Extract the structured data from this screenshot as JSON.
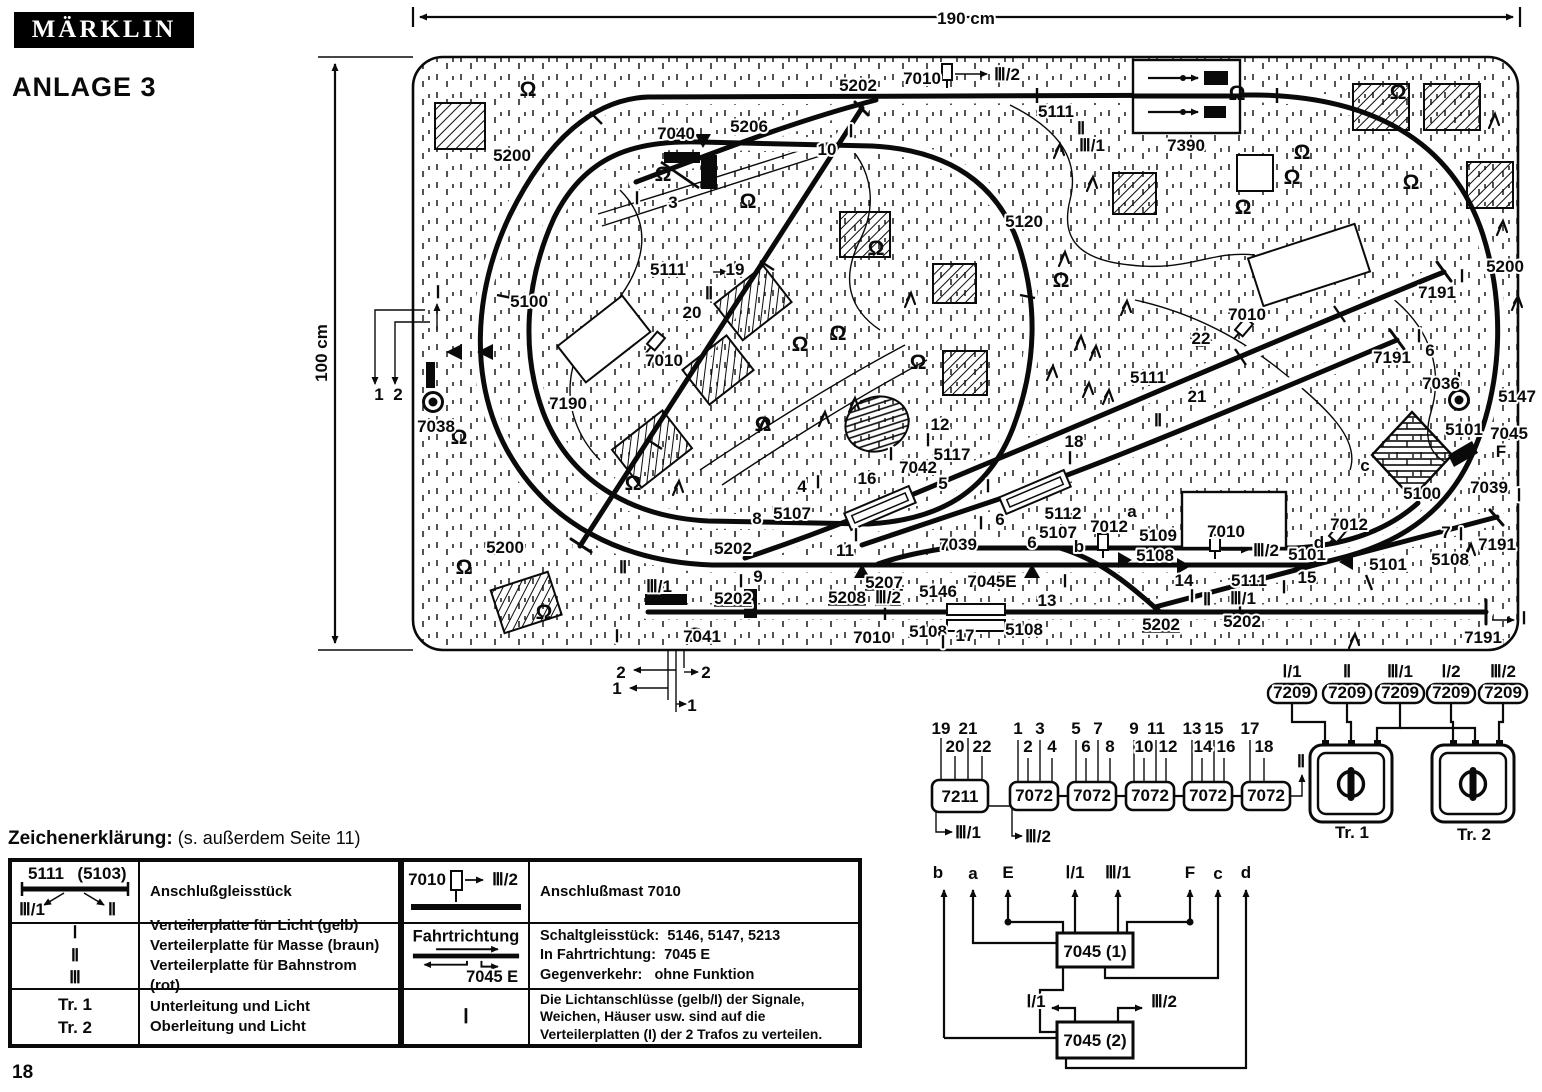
{
  "header": {
    "logo": "MÄRKLIN",
    "title": "ANLAGE 3"
  },
  "page": {
    "number": "18"
  },
  "plan": {
    "dim_w": "190 cm",
    "dim_h": "100 cm",
    "labels": [
      {
        "t": "5202",
        "x": 858,
        "y": 91
      },
      {
        "t": "7010",
        "x": 922,
        "y": 84
      },
      {
        "t": "Ⅲ/2",
        "x": 1007,
        "y": 80
      },
      {
        "t": "5111",
        "x": 1056,
        "y": 117,
        "s": 15
      },
      {
        "t": "Ⅱ",
        "x": 1081,
        "y": 134,
        "s": 15
      },
      {
        "t": "Ⅲ/1",
        "x": 1092,
        "y": 151,
        "s": 15
      },
      {
        "t": "7390",
        "x": 1186,
        "y": 151
      },
      {
        "t": "7040",
        "x": 676,
        "y": 139
      },
      {
        "t": "5206",
        "x": 749,
        "y": 132
      },
      {
        "t": "10",
        "x": 827,
        "y": 155,
        "s": 15
      },
      {
        "t": "Ⅰ",
        "x": 851,
        "y": 137,
        "s": 15
      },
      {
        "t": "Ⅰ",
        "x": 637,
        "y": 204,
        "s": 15
      },
      {
        "t": "3",
        "x": 673,
        "y": 208,
        "s": 15
      },
      {
        "t": "5200",
        "x": 512,
        "y": 161
      },
      {
        "t": "5120",
        "x": 1024,
        "y": 227
      },
      {
        "t": "5200",
        "x": 1505,
        "y": 272
      },
      {
        "t": "5111",
        "x": 668,
        "y": 275
      },
      {
        "t": "19",
        "x": 735,
        "y": 275,
        "s": 15
      },
      {
        "t": "Ⅱ",
        "x": 709,
        "y": 299,
        "s": 15
      },
      {
        "t": "20",
        "x": 692,
        "y": 318,
        "s": 15
      },
      {
        "t": "7010",
        "x": 664,
        "y": 366
      },
      {
        "t": "5100",
        "x": 529,
        "y": 307
      },
      {
        "t": "7190",
        "x": 568,
        "y": 409
      },
      {
        "t": "Ⅰ",
        "x": 438,
        "y": 298,
        "s": 15
      },
      {
        "t": "1",
        "x": 379,
        "y": 400,
        "s": 15
      },
      {
        "t": "2",
        "x": 398,
        "y": 400,
        "s": 15
      },
      {
        "t": "7038",
        "x": 436,
        "y": 432
      },
      {
        "t": "Ⅰ",
        "x": 1462,
        "y": 282,
        "s": 15
      },
      {
        "t": "7191",
        "x": 1437,
        "y": 298
      },
      {
        "t": "7010",
        "x": 1247,
        "y": 320
      },
      {
        "t": "22",
        "x": 1201,
        "y": 344,
        "s": 15
      },
      {
        "t": "5111",
        "x": 1148,
        "y": 383,
        "s": 15
      },
      {
        "t": "21",
        "x": 1197,
        "y": 402,
        "s": 15
      },
      {
        "t": "Ⅱ",
        "x": 1158,
        "y": 426,
        "s": 15
      },
      {
        "t": "7191",
        "x": 1392,
        "y": 363
      },
      {
        "t": "Ⅰ",
        "x": 1419,
        "y": 342,
        "s": 15
      },
      {
        "t": "6",
        "x": 1430,
        "y": 356,
        "s": 15
      },
      {
        "t": "7036",
        "x": 1441,
        "y": 389
      },
      {
        "t": "5147",
        "x": 1517,
        "y": 402
      },
      {
        "t": "5101",
        "x": 1464,
        "y": 435
      },
      {
        "t": "7045",
        "x": 1509,
        "y": 439
      },
      {
        "t": "F",
        "x": 1501,
        "y": 457
      },
      {
        "t": "c",
        "x": 1365,
        "y": 471,
        "s": 15
      },
      {
        "t": "5100",
        "x": 1422,
        "y": 499
      },
      {
        "t": "7039",
        "x": 1489,
        "y": 493
      },
      {
        "t": "Ⅰ",
        "x": 1519,
        "y": 501,
        "s": 15
      },
      {
        "t": "12",
        "x": 940,
        "y": 430,
        "s": 15
      },
      {
        "t": "Ⅰ",
        "x": 928,
        "y": 446,
        "s": 15
      },
      {
        "t": "5117",
        "x": 952,
        "y": 460
      },
      {
        "t": "7042",
        "x": 918,
        "y": 473
      },
      {
        "t": "Ⅰ",
        "x": 891,
        "y": 460,
        "s": 15
      },
      {
        "t": "16",
        "x": 867,
        "y": 484,
        "s": 15
      },
      {
        "t": "Ⅰ",
        "x": 818,
        "y": 488,
        "s": 15
      },
      {
        "t": "4",
        "x": 802,
        "y": 492,
        "s": 15
      },
      {
        "t": "5107",
        "x": 792,
        "y": 519
      },
      {
        "t": "8",
        "x": 757,
        "y": 524,
        "s": 15
      },
      {
        "t": "5",
        "x": 943,
        "y": 489,
        "s": 15
      },
      {
        "t": "Ⅰ",
        "x": 988,
        "y": 492,
        "s": 15
      },
      {
        "t": "18",
        "x": 1074,
        "y": 447,
        "s": 15
      },
      {
        "t": "Ⅰ",
        "x": 1070,
        "y": 464,
        "s": 15
      },
      {
        "t": "5112",
        "x": 1063,
        "y": 519
      },
      {
        "t": "Ⅰ",
        "x": 981,
        "y": 529,
        "s": 15
      },
      {
        "t": "6",
        "x": 1000,
        "y": 525,
        "s": 15
      },
      {
        "t": "6",
        "x": 1032,
        "y": 548,
        "s": 15
      },
      {
        "t": "7039",
        "x": 958,
        "y": 550
      },
      {
        "t": "5107",
        "x": 1058,
        "y": 538
      },
      {
        "t": "7012",
        "x": 1109,
        "y": 532
      },
      {
        "t": "a",
        "x": 1132,
        "y": 517,
        "s": 15
      },
      {
        "t": "b",
        "x": 1079,
        "y": 552,
        "s": 15
      },
      {
        "t": "5109",
        "x": 1158,
        "y": 541
      },
      {
        "t": "5108",
        "x": 1155,
        "y": 561
      },
      {
        "t": "Ⅰ",
        "x": 856,
        "y": 541,
        "s": 15
      },
      {
        "t": "11",
        "x": 845,
        "y": 556,
        "s": 15
      },
      {
        "t": "5200",
        "x": 505,
        "y": 553
      },
      {
        "t": "Ⅱ",
        "x": 623,
        "y": 573,
        "s": 15
      },
      {
        "t": "Ⅲ/1",
        "x": 659,
        "y": 592,
        "s": 15
      },
      {
        "t": "5202",
        "x": 733,
        "y": 554
      },
      {
        "t": "Ⅰ",
        "x": 741,
        "y": 587,
        "s": 15
      },
      {
        "t": "9",
        "x": 758,
        "y": 582,
        "s": 15
      },
      {
        "t": "5202",
        "x": 733,
        "y": 604,
        "u": 1
      },
      {
        "t": "5207",
        "x": 884,
        "y": 588,
        "u": 1
      },
      {
        "t": "5208",
        "x": 847,
        "y": 603,
        "u": 1
      },
      {
        "t": "Ⅲ/2",
        "x": 888,
        "y": 603,
        "u": 1
      },
      {
        "t": "5146",
        "x": 938,
        "y": 597
      },
      {
        "t": "7045E",
        "x": 992,
        "y": 587
      },
      {
        "t": "Ⅰ",
        "x": 1065,
        "y": 587,
        "s": 15
      },
      {
        "t": "13",
        "x": 1047,
        "y": 606,
        "s": 15
      },
      {
        "t": "7010",
        "x": 872,
        "y": 643
      },
      {
        "t": "5108",
        "x": 928,
        "y": 637
      },
      {
        "t": "Ⅰ",
        "x": 943,
        "y": 648,
        "s": 15
      },
      {
        "t": "17",
        "x": 965,
        "y": 641,
        "s": 15
      },
      {
        "t": "5108",
        "x": 1024,
        "y": 635
      },
      {
        "t": "5202",
        "x": 1161,
        "y": 630,
        "u": 1
      },
      {
        "t": "5202",
        "x": 1242,
        "y": 627
      },
      {
        "t": "7041",
        "x": 702,
        "y": 642
      },
      {
        "t": "Ⅰ",
        "x": 617,
        "y": 642,
        "s": 15
      },
      {
        "t": "2",
        "x": 621,
        "y": 678,
        "s": 15
      },
      {
        "t": "2",
        "x": 706,
        "y": 678,
        "s": 15
      },
      {
        "t": "1",
        "x": 617,
        "y": 694,
        "s": 15
      },
      {
        "t": "1",
        "x": 692,
        "y": 711,
        "s": 15
      },
      {
        "t": "14",
        "x": 1184,
        "y": 586,
        "s": 15
      },
      {
        "t": "Ⅰ",
        "x": 1192,
        "y": 602,
        "s": 15
      },
      {
        "t": "Ⅱ",
        "x": 1207,
        "y": 605,
        "s": 15
      },
      {
        "t": "Ⅲ/1",
        "x": 1243,
        "y": 604,
        "s": 15
      },
      {
        "t": "5111",
        "x": 1249,
        "y": 586,
        "s": 15
      },
      {
        "t": "Ⅰ",
        "x": 1284,
        "y": 593,
        "s": 15
      },
      {
        "t": "15",
        "x": 1307,
        "y": 583,
        "s": 15
      },
      {
        "t": "7010",
        "x": 1226,
        "y": 537
      },
      {
        "t": "Ⅲ/2",
        "x": 1266,
        "y": 556,
        "s": 15
      },
      {
        "t": "5101",
        "x": 1307,
        "y": 560
      },
      {
        "t": "d",
        "x": 1319,
        "y": 548,
        "s": 15
      },
      {
        "t": "7012",
        "x": 1349,
        "y": 530
      },
      {
        "t": "5101",
        "x": 1388,
        "y": 570
      },
      {
        "t": "7",
        "x": 1446,
        "y": 538,
        "s": 15
      },
      {
        "t": "Ⅰ",
        "x": 1461,
        "y": 540,
        "s": 15
      },
      {
        "t": "5108",
        "x": 1450,
        "y": 565
      },
      {
        "t": "7191",
        "x": 1497,
        "y": 550
      },
      {
        "t": "7191",
        "x": 1483,
        "y": 643
      },
      {
        "t": "Ⅰ",
        "x": 1524,
        "y": 624,
        "s": 15
      }
    ],
    "bushes": [
      [
        528,
        96
      ],
      [
        663,
        181
      ],
      [
        748,
        208
      ],
      [
        800,
        351
      ],
      [
        838,
        340
      ],
      [
        918,
        369
      ],
      [
        763,
        431
      ],
      [
        633,
        490
      ],
      [
        695,
        642
      ],
      [
        464,
        574
      ],
      [
        544,
        619
      ],
      [
        1243,
        214
      ],
      [
        1292,
        184
      ],
      [
        1411,
        189
      ],
      [
        1302,
        159
      ],
      [
        1237,
        100
      ],
      [
        1398,
        99
      ],
      [
        459,
        444
      ],
      [
        1061,
        287
      ],
      [
        876,
        255
      ]
    ],
    "trees": [
      [
        1053,
        143
      ],
      [
        1086,
        176
      ],
      [
        1488,
        113
      ],
      [
        1496,
        220
      ],
      [
        1058,
        251
      ],
      [
        1074,
        335
      ],
      [
        1089,
        345
      ],
      [
        1046,
        365
      ],
      [
        1082,
        382
      ],
      [
        1102,
        389
      ],
      [
        1464,
        543
      ],
      [
        1511,
        295
      ],
      [
        818,
        411
      ],
      [
        848,
        397
      ],
      [
        904,
        292
      ],
      [
        758,
        417
      ],
      [
        1348,
        633
      ],
      [
        672,
        480
      ],
      [
        1120,
        300
      ]
    ]
  },
  "wiring": {
    "labels": [
      {
        "t": "19",
        "x": 41,
        "y": 74,
        "s": 14
      },
      {
        "t": "20",
        "x": 55,
        "y": 92,
        "s": 14
      },
      {
        "t": "21",
        "x": 68,
        "y": 74,
        "s": 14
      },
      {
        "t": "22",
        "x": 82,
        "y": 92,
        "s": 14
      },
      {
        "t": "1",
        "x": 118,
        "y": 74,
        "s": 14
      },
      {
        "t": "2",
        "x": 128,
        "y": 92,
        "s": 14
      },
      {
        "t": "3",
        "x": 140,
        "y": 74,
        "s": 14
      },
      {
        "t": "4",
        "x": 152,
        "y": 92,
        "s": 14
      },
      {
        "t": "5",
        "x": 176,
        "y": 74,
        "s": 14
      },
      {
        "t": "6",
        "x": 186,
        "y": 92,
        "s": 14
      },
      {
        "t": "7",
        "x": 198,
        "y": 74,
        "s": 14
      },
      {
        "t": "8",
        "x": 210,
        "y": 92,
        "s": 14
      },
      {
        "t": "9",
        "x": 234,
        "y": 74,
        "s": 14
      },
      {
        "t": "10",
        "x": 244,
        "y": 92,
        "s": 14
      },
      {
        "t": "11",
        "x": 256,
        "y": 74,
        "s": 14
      },
      {
        "t": "12",
        "x": 268,
        "y": 92,
        "s": 14
      },
      {
        "t": "13",
        "x": 292,
        "y": 74,
        "s": 14
      },
      {
        "t": "14",
        "x": 303,
        "y": 92,
        "s": 14
      },
      {
        "t": "15",
        "x": 314,
        "y": 74,
        "s": 14
      },
      {
        "t": "16",
        "x": 326,
        "y": 92,
        "s": 14
      },
      {
        "t": "17",
        "x": 350,
        "y": 74,
        "s": 14
      },
      {
        "t": "18",
        "x": 364,
        "y": 92,
        "s": 14
      },
      {
        "t": "7211",
        "x": 60,
        "y": 142,
        "s": 15
      },
      {
        "t": "7072",
        "x": 134,
        "y": 141,
        "s": 15
      },
      {
        "t": "7072",
        "x": 192,
        "y": 141,
        "s": 15
      },
      {
        "t": "7072",
        "x": 250,
        "y": 141,
        "s": 15
      },
      {
        "t": "7072",
        "x": 308,
        "y": 141,
        "s": 15
      },
      {
        "t": "7072",
        "x": 366,
        "y": 141,
        "s": 15
      },
      {
        "t": "Ⅲ/1",
        "x": 68,
        "y": 178,
        "s": 15
      },
      {
        "t": "Ⅲ/2",
        "x": 138,
        "y": 182,
        "s": 15
      },
      {
        "t": "Ⅱ",
        "x": 401,
        "y": 107,
        "s": 15
      },
      {
        "t": "Ⅰ/1",
        "x": 392,
        "y": 17,
        "s": 15
      },
      {
        "t": "Ⅱ",
        "x": 447,
        "y": 17,
        "s": 15
      },
      {
        "t": "Ⅲ/1",
        "x": 500,
        "y": 17,
        "s": 15
      },
      {
        "t": "Ⅰ/2",
        "x": 551,
        "y": 17,
        "s": 15
      },
      {
        "t": "Ⅲ/2",
        "x": 603,
        "y": 17,
        "s": 15
      },
      {
        "t": "7209",
        "x": 392,
        "y": 38,
        "s": 13
      },
      {
        "t": "7209",
        "x": 447,
        "y": 38,
        "s": 13
      },
      {
        "t": "7209",
        "x": 500,
        "y": 38,
        "s": 13
      },
      {
        "t": "7209",
        "x": 551,
        "y": 38,
        "s": 13
      },
      {
        "t": "7209",
        "x": 603,
        "y": 38,
        "s": 13
      },
      {
        "t": "Tr. 1",
        "x": 452,
        "y": 178,
        "s": 18
      },
      {
        "t": "Tr. 2",
        "x": 574,
        "y": 180,
        "s": 18
      },
      {
        "t": "b",
        "x": 38,
        "y": 218,
        "s": 16
      },
      {
        "t": "a",
        "x": 73,
        "y": 219,
        "s": 16
      },
      {
        "t": "E",
        "x": 108,
        "y": 218,
        "s": 16
      },
      {
        "t": "Ⅰ/1",
        "x": 175,
        "y": 218,
        "s": 16
      },
      {
        "t": "Ⅲ/1",
        "x": 218,
        "y": 218,
        "s": 16
      },
      {
        "t": "F",
        "x": 290,
        "y": 218,
        "s": 16
      },
      {
        "t": "c",
        "x": 318,
        "y": 219,
        "s": 16
      },
      {
        "t": "d",
        "x": 346,
        "y": 218,
        "s": 16
      },
      {
        "t": "7045 (1)",
        "x": 195,
        "y": 297,
        "s": 16
      },
      {
        "t": "7045 (2)",
        "x": 195,
        "y": 386,
        "s": 16
      },
      {
        "t": "Ⅰ/1",
        "x": 136,
        "y": 347,
        "s": 15
      },
      {
        "t": "Ⅲ/2",
        "x": 264,
        "y": 347,
        "s": 15
      }
    ]
  },
  "legend": {
    "heading": "Zeichenerklärung:",
    "note": "(s. außerdem Seite 11)",
    "left": {
      "r1": {
        "s1": "5111",
        "s2": "(5103)",
        "s3": "Ⅲ/1",
        "s4": "Ⅱ",
        "desc": "Anschlußgleisstück"
      },
      "r2": {
        "k1": "Ⅰ",
        "k2": "Ⅱ",
        "k3": "Ⅲ",
        "d1": "Verteilerplatte für Licht (gelb)",
        "d2": "Verteilerplatte für Masse (braun)",
        "d3": "Verteilerplatte für Bahnstrom (rot)"
      },
      "r3": {
        "k1": "Tr. 1",
        "k2": "Tr. 2",
        "d1": "Unterleitung und Licht",
        "d2": "Oberleitung und Licht"
      }
    },
    "right": {
      "r1": {
        "s1": "7010",
        "s2": "Ⅲ/2",
        "desc": "Anschlußmast 7010"
      },
      "r2": {
        "k": "Fahrtrichtung",
        "k2": "7045 E",
        "l1a": "Schaltgleisstück:",
        "l1b": "5146, 5147, 5213",
        "l2a": "In Fahrtrichtung:",
        "l2b": "7045 E",
        "l3a": "Gegenverkehr:",
        "l3b": "ohne Funktion"
      },
      "r3": {
        "k": "Ⅰ",
        "desc": "Die Lichtanschlüsse (gelb/I) der Signale, Weichen, Häuser usw. sind auf die Verteilerplatten (I) der 2 Trafos zu verteilen."
      }
    }
  }
}
